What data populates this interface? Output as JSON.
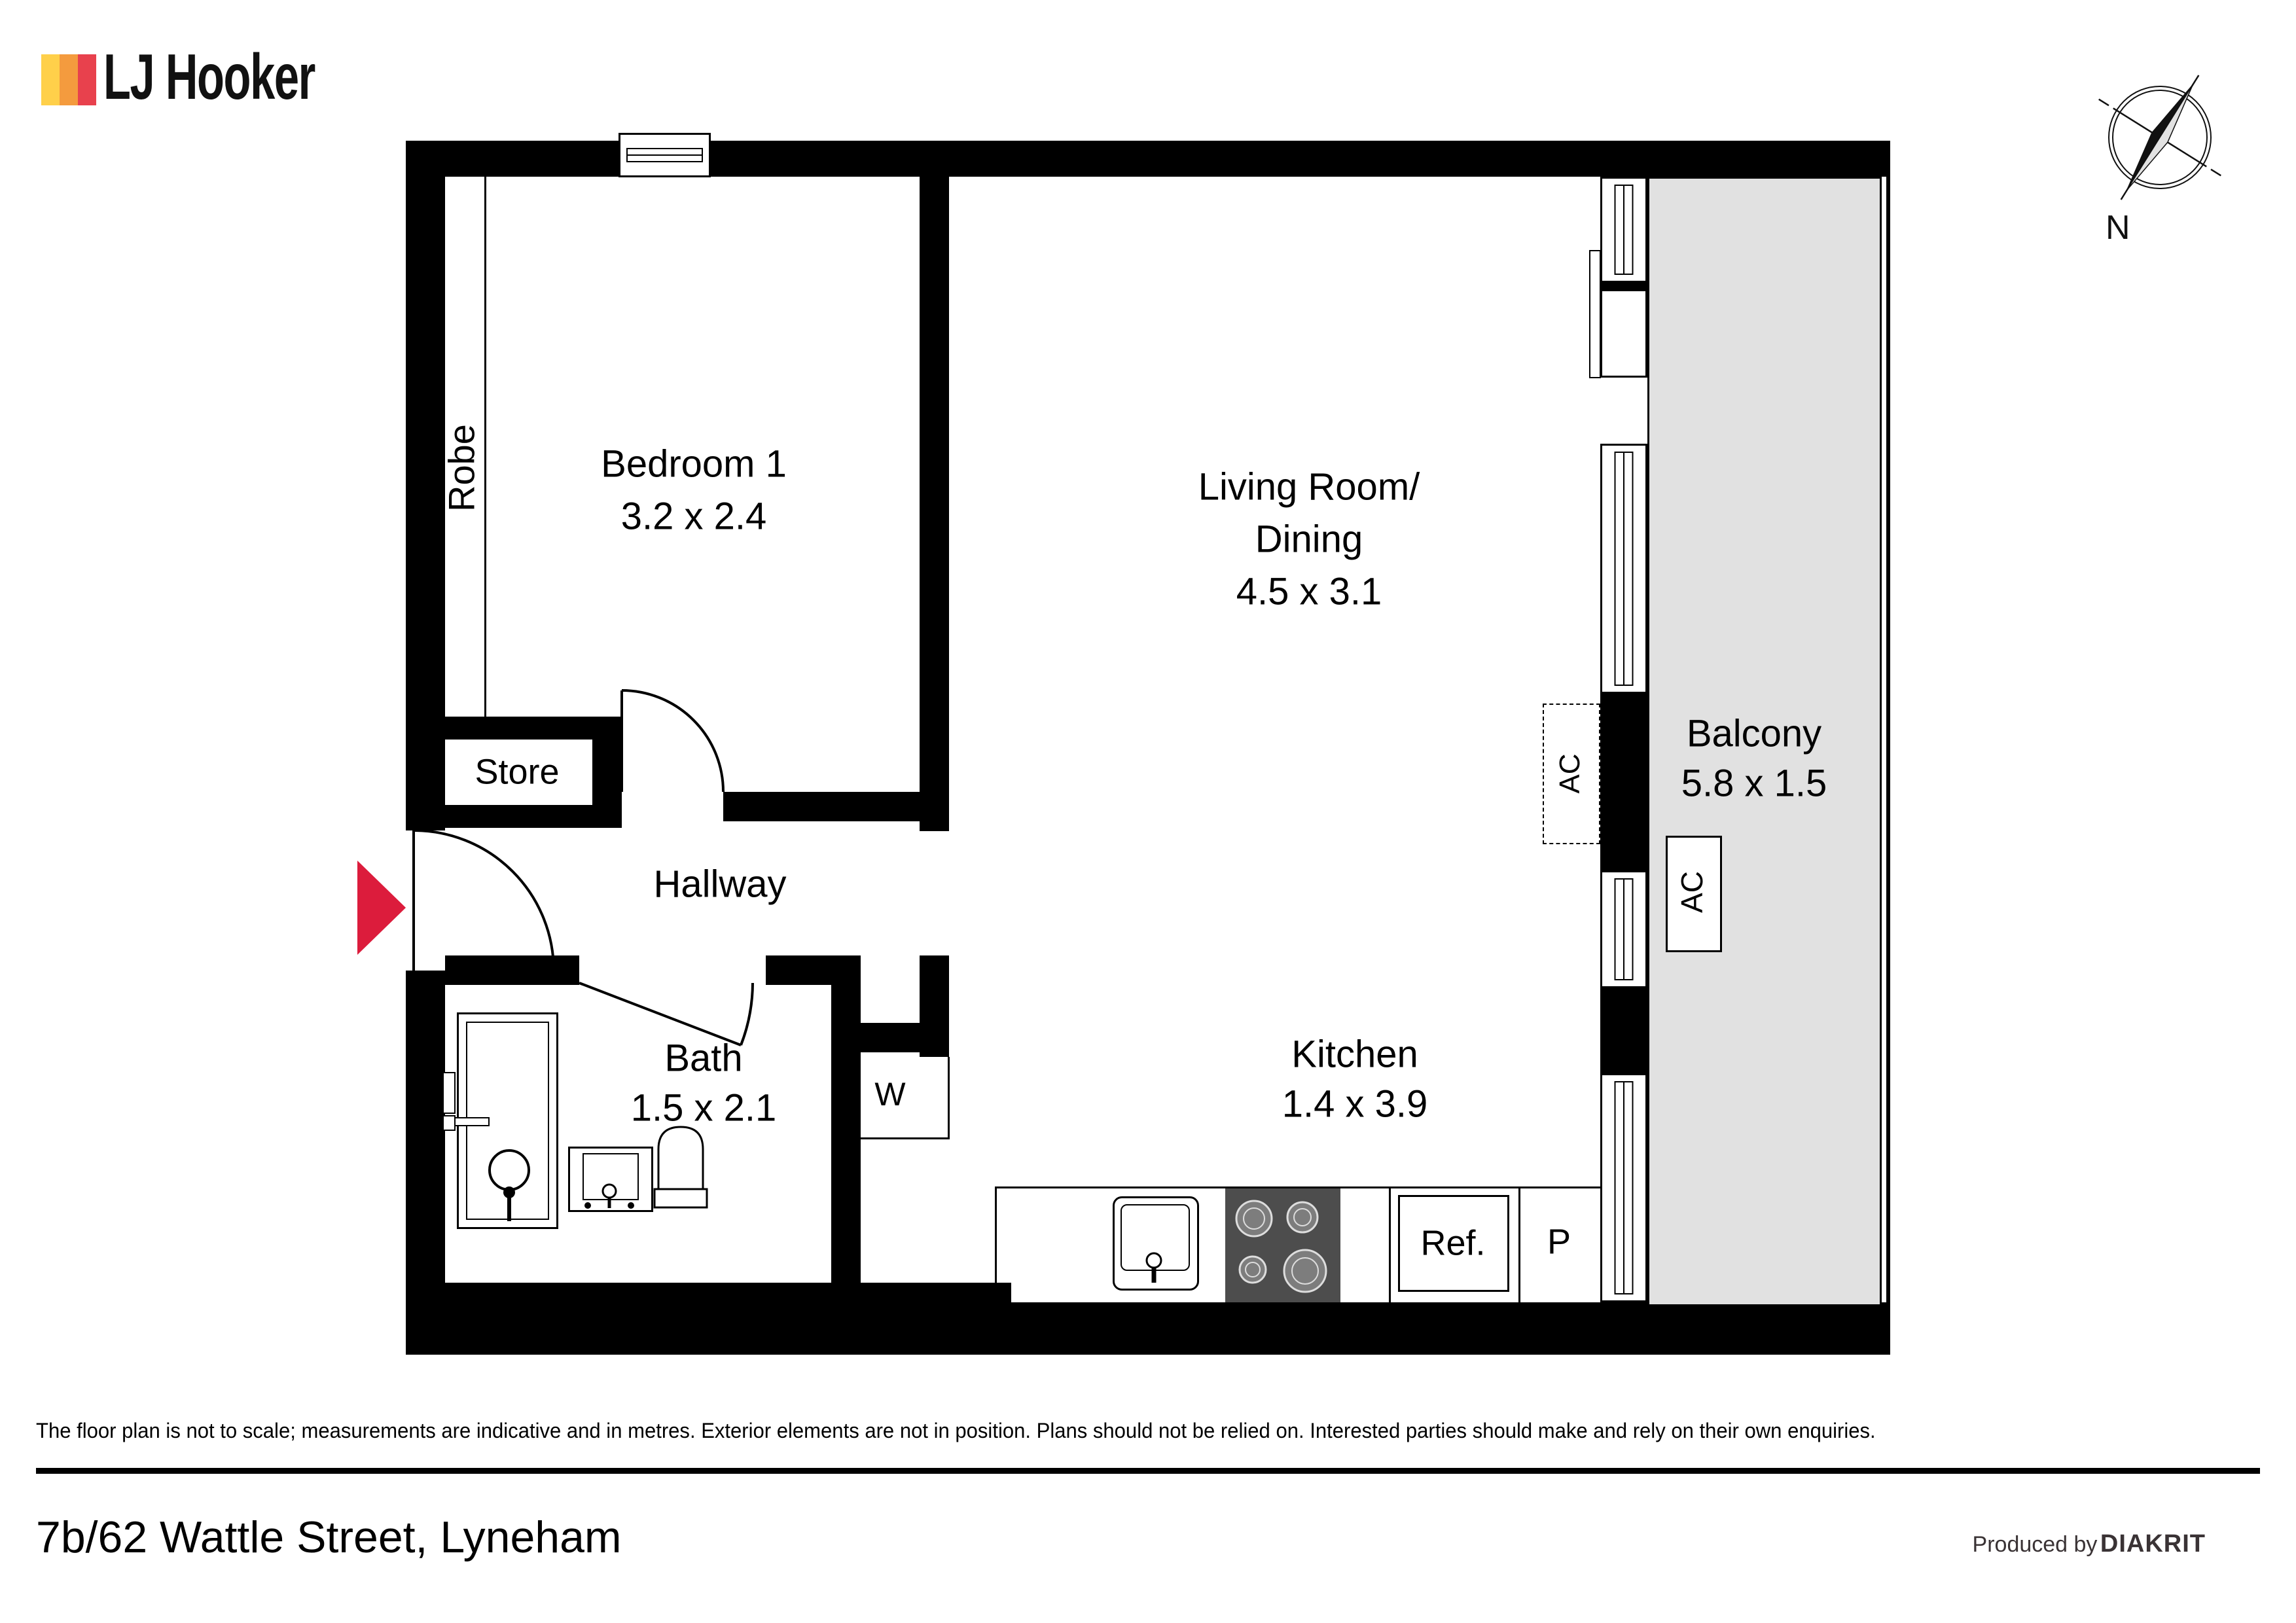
{
  "header": {
    "brand": "LJ Hooker"
  },
  "compass": {
    "north_label": "N"
  },
  "floorplan": {
    "rooms": [
      {
        "id": "bedroom1",
        "name": "Bedroom 1",
        "dims": "3.2 x 2.4"
      },
      {
        "id": "living",
        "name": "Living Room/",
        "name2": "Dining",
        "dims": "4.5 x 3.1"
      },
      {
        "id": "kitchen",
        "name": "Kitchen",
        "dims": "1.4 x 3.9"
      },
      {
        "id": "bath",
        "name": "Bath",
        "dims": "1.5 x 2.1"
      },
      {
        "id": "balcony",
        "name": "Balcony",
        "dims": "5.8 x 1.5"
      },
      {
        "id": "hallway",
        "name": "Hallway"
      },
      {
        "id": "robe",
        "name": "Robe"
      },
      {
        "id": "store",
        "name": "Store"
      },
      {
        "id": "laundry",
        "name": "W"
      },
      {
        "id": "fridge",
        "name": "Ref."
      },
      {
        "id": "pantry",
        "name": "P"
      },
      {
        "id": "ac_wall",
        "name": "AC"
      },
      {
        "id": "ac_balcony",
        "name": "AC"
      }
    ],
    "colors": {
      "wall": "#000000",
      "balcony_floor": "#e1e1e1",
      "stove": "#4d4d4d",
      "burner": "#7d7d7d",
      "arrow_red": "#dc1c3c",
      "logo_yellow": "#ffd04a",
      "logo_orange": "#f49b3e",
      "logo_red": "#e8414d",
      "footer_text": "#3a3335"
    }
  },
  "footer": {
    "disclaimer": "The floor plan is not to scale; measurements are indicative and in metres. Exterior elements are not in position. Plans should not be relied on. Interested parties should make and rely on their own enquiries.",
    "address": "7b/62 Wattle Street, Lyneham",
    "produced_by": "Produced by",
    "producer": "DIAKRIT"
  }
}
